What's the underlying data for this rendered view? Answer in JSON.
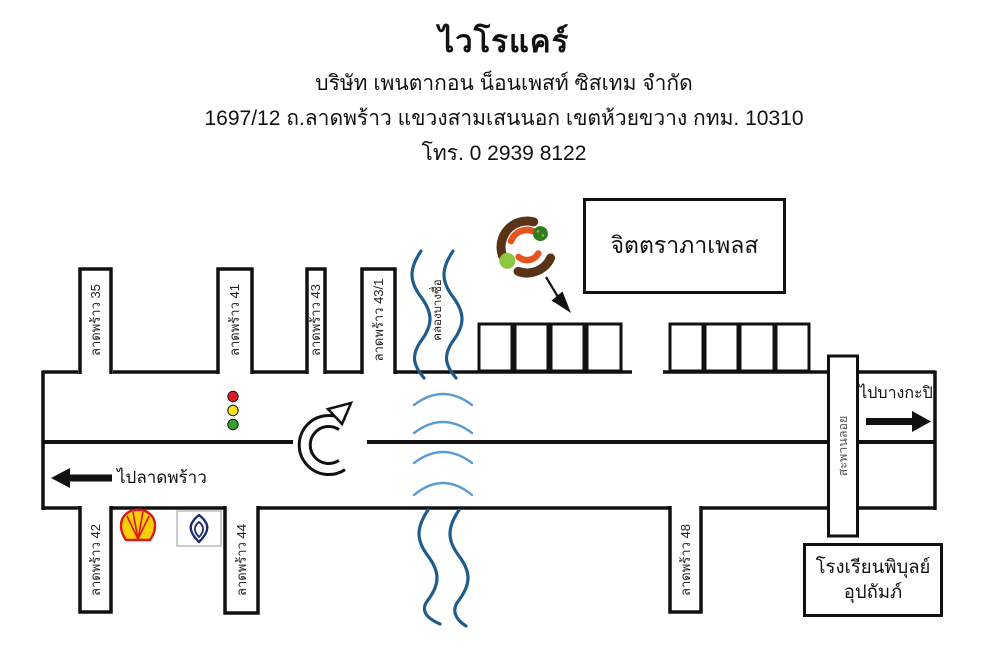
{
  "header": {
    "title": "ไวโรแคร์",
    "company": "บริษัท เพนตากอน น็อนเพสท์ ซิสเทม จำกัด",
    "address": "1697/12 ถ.ลาดพร้าว แขวงสามเสนนอก เขตห้วยขวาง กทม. 10310",
    "phone": "โทร. 0 2939 8122"
  },
  "map": {
    "sois_top": [
      "ลาดพร้าว 35",
      "ลาดพร้าว 41",
      "ลาดพร้าว 43",
      "ลาดพร้าว 43/1"
    ],
    "sois_bottom": [
      "ลาดพร้าว 42",
      "ลาดพร้าว 44",
      "ลาดพร้าว 48"
    ],
    "canal_label": "คลองบางซื่อ",
    "building_box": "จิตตราภาเพลส",
    "school_box": {
      "line1": "โรงเรียนพิบุลย์",
      "line2": "อุปถัมภ์"
    },
    "overpass_label": "สะพานลอย",
    "direction_left": "ไปลาดพร้าว",
    "direction_right": "ไปบางกะปิ",
    "icons": {
      "company_logo": "vairocare-company-logo",
      "shell": "shell-gas-station-icon",
      "bangchak": "bangchak-gas-station-icon",
      "traffic_light": "traffic-light-icon",
      "u_turn": "u-turn-arrow-icon",
      "pointer": "location-pointer-arrow",
      "canal": "canal-wavy-lines",
      "bridge": "bridge-arcs"
    },
    "colors": {
      "road": "#111111",
      "canal_dark_blue": "#1f5c8b",
      "bridge_arc_blue": "#5b9bd5",
      "logo_brown": "#5a3317",
      "logo_orange": "#e8541d",
      "logo_green_dark": "#2f7d1f",
      "logo_green_light": "#8dc63f",
      "shell_red": "#d71a21",
      "shell_yellow": "#fbce07",
      "bangchak_navy": "#1a2d71",
      "traffic_red": "#e01b24",
      "traffic_yellow": "#f7e11e",
      "traffic_green": "#33a02c"
    }
  }
}
